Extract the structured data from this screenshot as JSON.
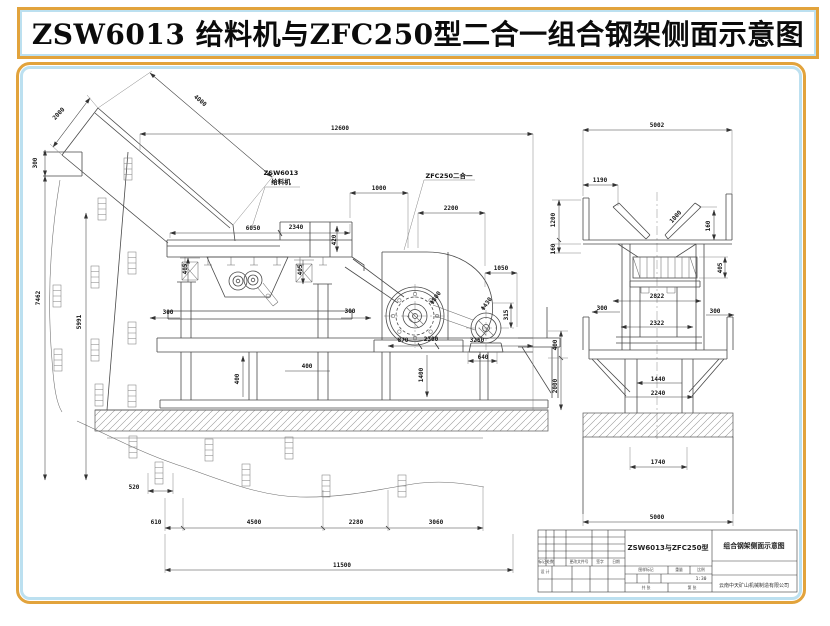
{
  "page": {
    "title": "ZSW6013 给料机与ZFC250型二合一组合钢架侧面示意图"
  },
  "colors": {
    "accent_orange": "#e2a33c",
    "accent_blue": "#bce0f0",
    "line": "#4a4a4a"
  },
  "equipment_labels": {
    "feeder_model": "ZSW6013",
    "feeder_name": "给料机",
    "crusher_name": "ZFC250二合一"
  },
  "title_block": {
    "model": "ZSW6013与ZFC250型",
    "drawing_title": "组合钢架侧面示意图",
    "company": "云南中天矿山机械制造有限公司",
    "scale_value": "1:30",
    "col_mark": "标记",
    "col_count": "处数",
    "col_doc": "更改文件号",
    "col_sign": "签字",
    "col_date": "日期",
    "row_design": "设 计",
    "stamp": "图样标记",
    "weight": "重量",
    "scale": "比例",
    "sheets_total": "共 张",
    "sheet_no": "第 张"
  },
  "annotations": [
    {
      "t": "2000",
      "x": 60,
      "y": 115,
      "r": -47
    },
    {
      "t": "4000",
      "x": 199,
      "y": 102,
      "r": 40
    },
    {
      "t": "300",
      "x": 37,
      "y": 163,
      "r": -90
    },
    {
      "t": "7462",
      "x": 40,
      "y": 298,
      "r": -90
    },
    {
      "t": "5991",
      "x": 81,
      "y": 322,
      "r": -90
    },
    {
      "t": "12600",
      "x": 340,
      "y": 130
    },
    {
      "t": "1000",
      "x": 379,
      "y": 190
    },
    {
      "t": "2200",
      "x": 451,
      "y": 210
    },
    {
      "t": "6050",
      "x": 253,
      "y": 230
    },
    {
      "t": "2340",
      "x": 296,
      "y": 229
    },
    {
      "t": "420",
      "x": 336,
      "y": 240,
      "r": -90
    },
    {
      "t": "405",
      "x": 187,
      "y": 269,
      "r": -90
    },
    {
      "t": "405",
      "x": 302,
      "y": 270,
      "r": -90
    },
    {
      "t": "1050",
      "x": 501,
      "y": 270
    },
    {
      "t": "300",
      "x": 168,
      "y": 314
    },
    {
      "t": "300",
      "x": 350,
      "y": 313
    },
    {
      "t": "Φ800",
      "x": 437,
      "y": 299,
      "r": -55
    },
    {
      "t": "Φ430",
      "x": 488,
      "y": 305,
      "r": -55
    },
    {
      "t": "315",
      "x": 508,
      "y": 315,
      "r": -90
    },
    {
      "t": "870",
      "x": 403,
      "y": 342
    },
    {
      "t": "2300",
      "x": 431,
      "y": 341
    },
    {
      "t": "3250",
      "x": 477,
      "y": 342
    },
    {
      "t": "640",
      "x": 483,
      "y": 359
    },
    {
      "t": "400",
      "x": 239,
      "y": 379,
      "r": -90
    },
    {
      "t": "400",
      "x": 307,
      "y": 368
    },
    {
      "t": "1400",
      "x": 423,
      "y": 375,
      "r": -90
    },
    {
      "t": "400",
      "x": 557,
      "y": 345,
      "r": -90
    },
    {
      "t": "2000",
      "x": 557,
      "y": 386,
      "r": -90
    },
    {
      "t": "520",
      "x": 134,
      "y": 489
    },
    {
      "t": "610",
      "x": 156,
      "y": 524
    },
    {
      "t": "4500",
      "x": 254,
      "y": 524
    },
    {
      "t": "2280",
      "x": 356,
      "y": 524
    },
    {
      "t": "3060",
      "x": 436,
      "y": 524
    },
    {
      "t": "11500",
      "x": 342,
      "y": 567
    },
    {
      "t": "5002",
      "x": 657,
      "y": 127
    },
    {
      "t": "1190",
      "x": 600,
      "y": 182
    },
    {
      "t": "1200",
      "x": 555,
      "y": 220,
      "r": -90
    },
    {
      "t": "160",
      "x": 555,
      "y": 249,
      "r": -90
    },
    {
      "t": "1000",
      "x": 677,
      "y": 218,
      "r": -48
    },
    {
      "t": "160",
      "x": 710,
      "y": 226,
      "r": -90
    },
    {
      "t": "405",
      "x": 722,
      "y": 268,
      "r": -90
    },
    {
      "t": "2822",
      "x": 657,
      "y": 298
    },
    {
      "t": "300",
      "x": 602,
      "y": 310
    },
    {
      "t": "300",
      "x": 715,
      "y": 313
    },
    {
      "t": "2322",
      "x": 657,
      "y": 325
    },
    {
      "t": "1440",
      "x": 658,
      "y": 381
    },
    {
      "t": "2240",
      "x": 658,
      "y": 395
    },
    {
      "t": "1740",
      "x": 658,
      "y": 464
    },
    {
      "t": "5000",
      "x": 657,
      "y": 519
    }
  ]
}
